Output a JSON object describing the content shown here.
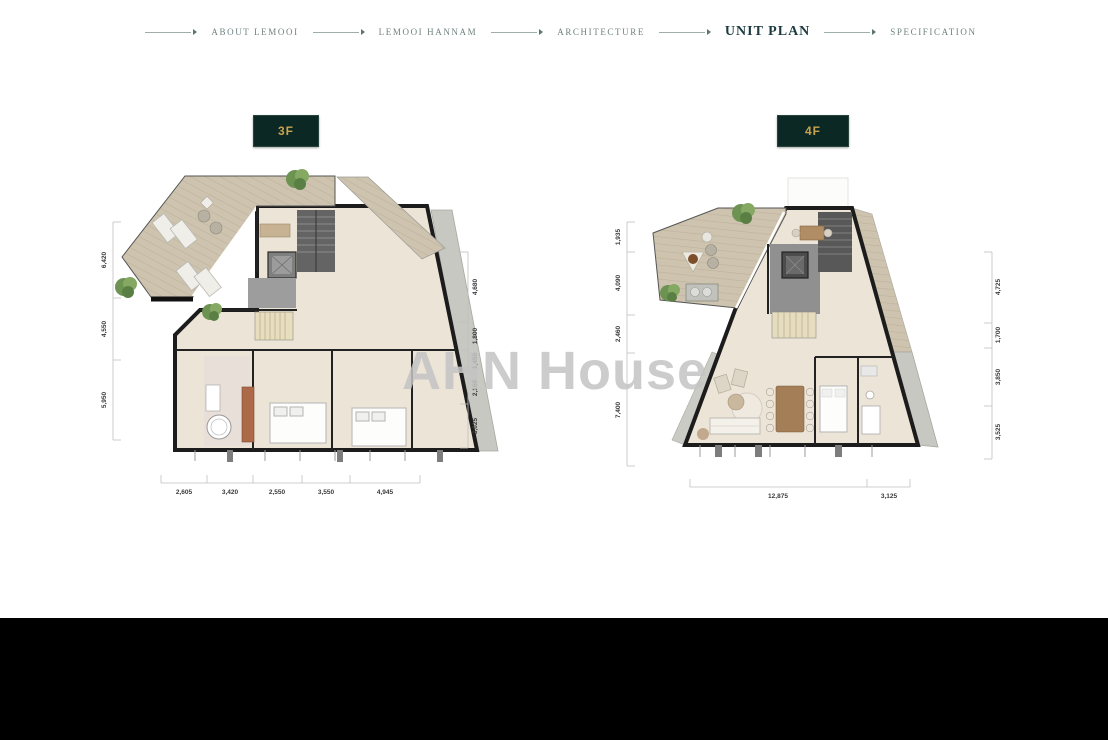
{
  "nav": {
    "items": [
      {
        "label": "ABOUT LEMOOI",
        "active": false
      },
      {
        "label": "LEMOOI HANNAM",
        "active": false
      },
      {
        "label": "ARCHITECTURE",
        "active": false
      },
      {
        "label": "UNIT PLAN",
        "active": true
      },
      {
        "label": "SPECIFICATION",
        "active": false
      }
    ]
  },
  "watermark": "AHN House",
  "colors": {
    "tag_background": "#0b2824",
    "tag_text": "#c9a24f",
    "nav_active": "#1c3a3f",
    "deck_wood": "#cdc3ae",
    "interior_floor": "#ece5d7",
    "stone_band": "#c8c8c2"
  },
  "plans": [
    {
      "tag": "3F",
      "dims_left": [
        "6,420",
        "4,550",
        "5,950"
      ],
      "dims_right": [
        "4,680",
        "1,800",
        "1,450",
        "2,160",
        "3,025"
      ],
      "dims_bottom": [
        "2,605",
        "3,420",
        "2,550",
        "3,550",
        "4,945"
      ]
    },
    {
      "tag": "4F",
      "dims_left": [
        "1,935",
        "4,090",
        "2,460",
        "7,400"
      ],
      "dims_right": [
        "4,725",
        "1,700",
        "3,850",
        "3,525"
      ],
      "dims_bottom": [
        "12,875",
        "3,125"
      ]
    }
  ]
}
